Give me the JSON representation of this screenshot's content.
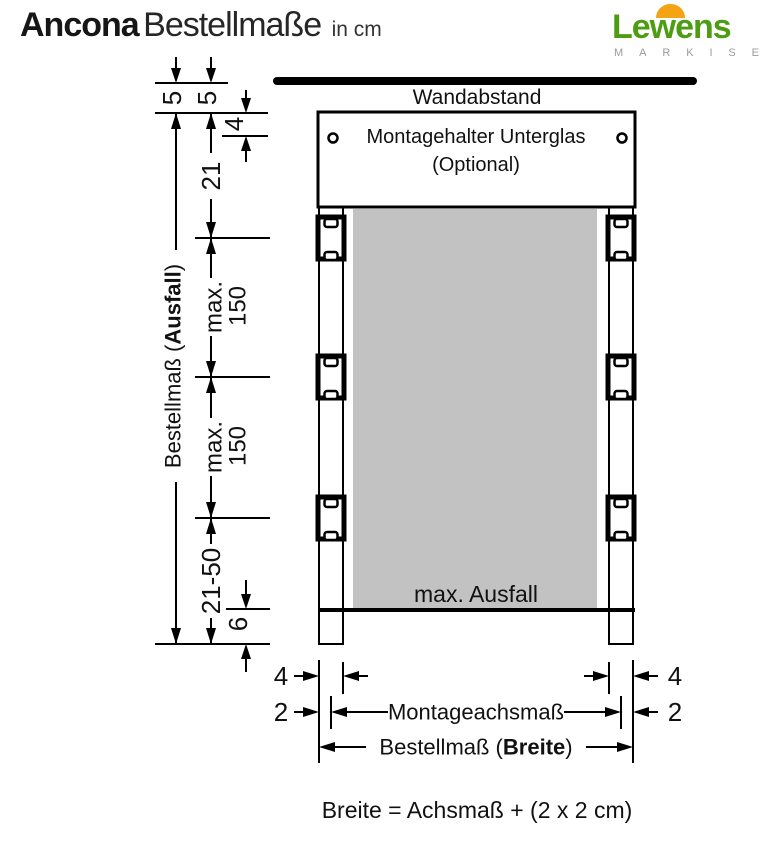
{
  "header": {
    "title": {
      "product": "Ancona",
      "subtitle": "Bestellmaße",
      "unit": "in cm"
    },
    "logo": {
      "name": "Lewens",
      "tagline": "MARKISEN",
      "green": "#4e9c12",
      "orange": "#f4a314",
      "tagline_color": "#9b9b9b"
    }
  },
  "diagram": {
    "wall_label": "Wandabstand",
    "bracket_box": {
      "line1": "Montagehalter Unterglas",
      "line2": "(Optional)"
    },
    "fabric_label": "max. Ausfall",
    "fabric_color": "#c2c2c2",
    "formula": "Breite = Achsmaß + (2 x 2 cm)",
    "dims": {
      "wall_gap_outer": "5",
      "wall_gap_inner": "5",
      "glass_offset": "4",
      "top_bracket_distance": "21",
      "bracket_spacing_prefix": "max.",
      "bracket_spacing_value": "150",
      "bottom_range": "21-50",
      "foot_height": "6",
      "total_height": {
        "pre": "Bestellmaß (",
        "bold": "Ausfall",
        "post": ")"
      },
      "rail_width": "4",
      "edge_offset": "2",
      "axis_width_label": "Montageachsmaß",
      "order_width": {
        "pre": "Bestellmaß (",
        "bold": "Breite",
        "post": ")"
      }
    }
  }
}
